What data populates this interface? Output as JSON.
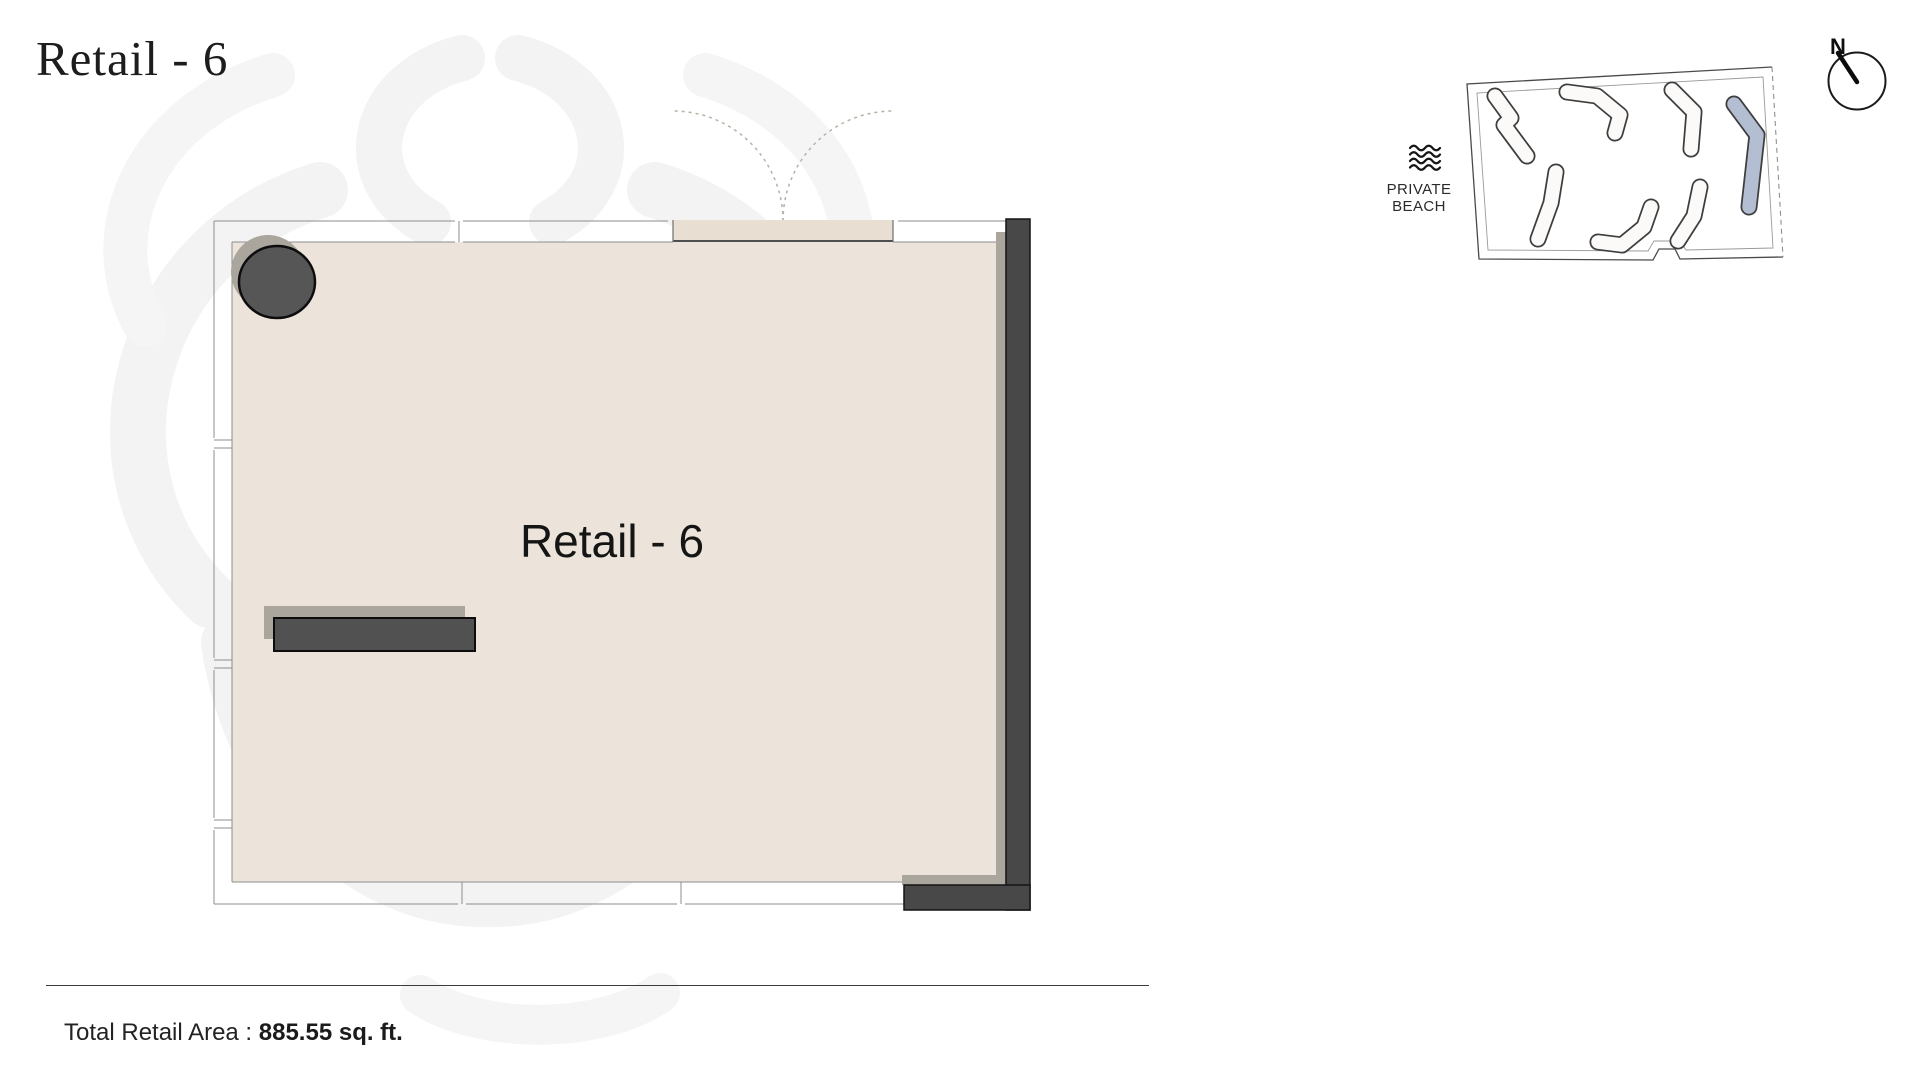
{
  "header": {
    "title": "Retail - 6"
  },
  "floor_plan": {
    "room_label": "Retail - 6"
  },
  "site_map": {
    "beach_label_line1": "PRIVATE",
    "beach_label_line2": "BEACH",
    "compass_label": "N"
  },
  "footer": {
    "area_label": "Total Retail Area : ",
    "area_value": "885.55 sq. ft."
  },
  "colors": {
    "floor": "#ece4da",
    "threshold": "#e8dfd2",
    "wall": "#484848",
    "shadow": "#aba69d",
    "line": "#8c8c8c",
    "arc": "#b9b1a6",
    "highlight": "#b4bed3",
    "bldg_stroke": "#3e3e3e",
    "bldg_fill": "#fbfaf8",
    "watermark": "#f3f3f3"
  }
}
